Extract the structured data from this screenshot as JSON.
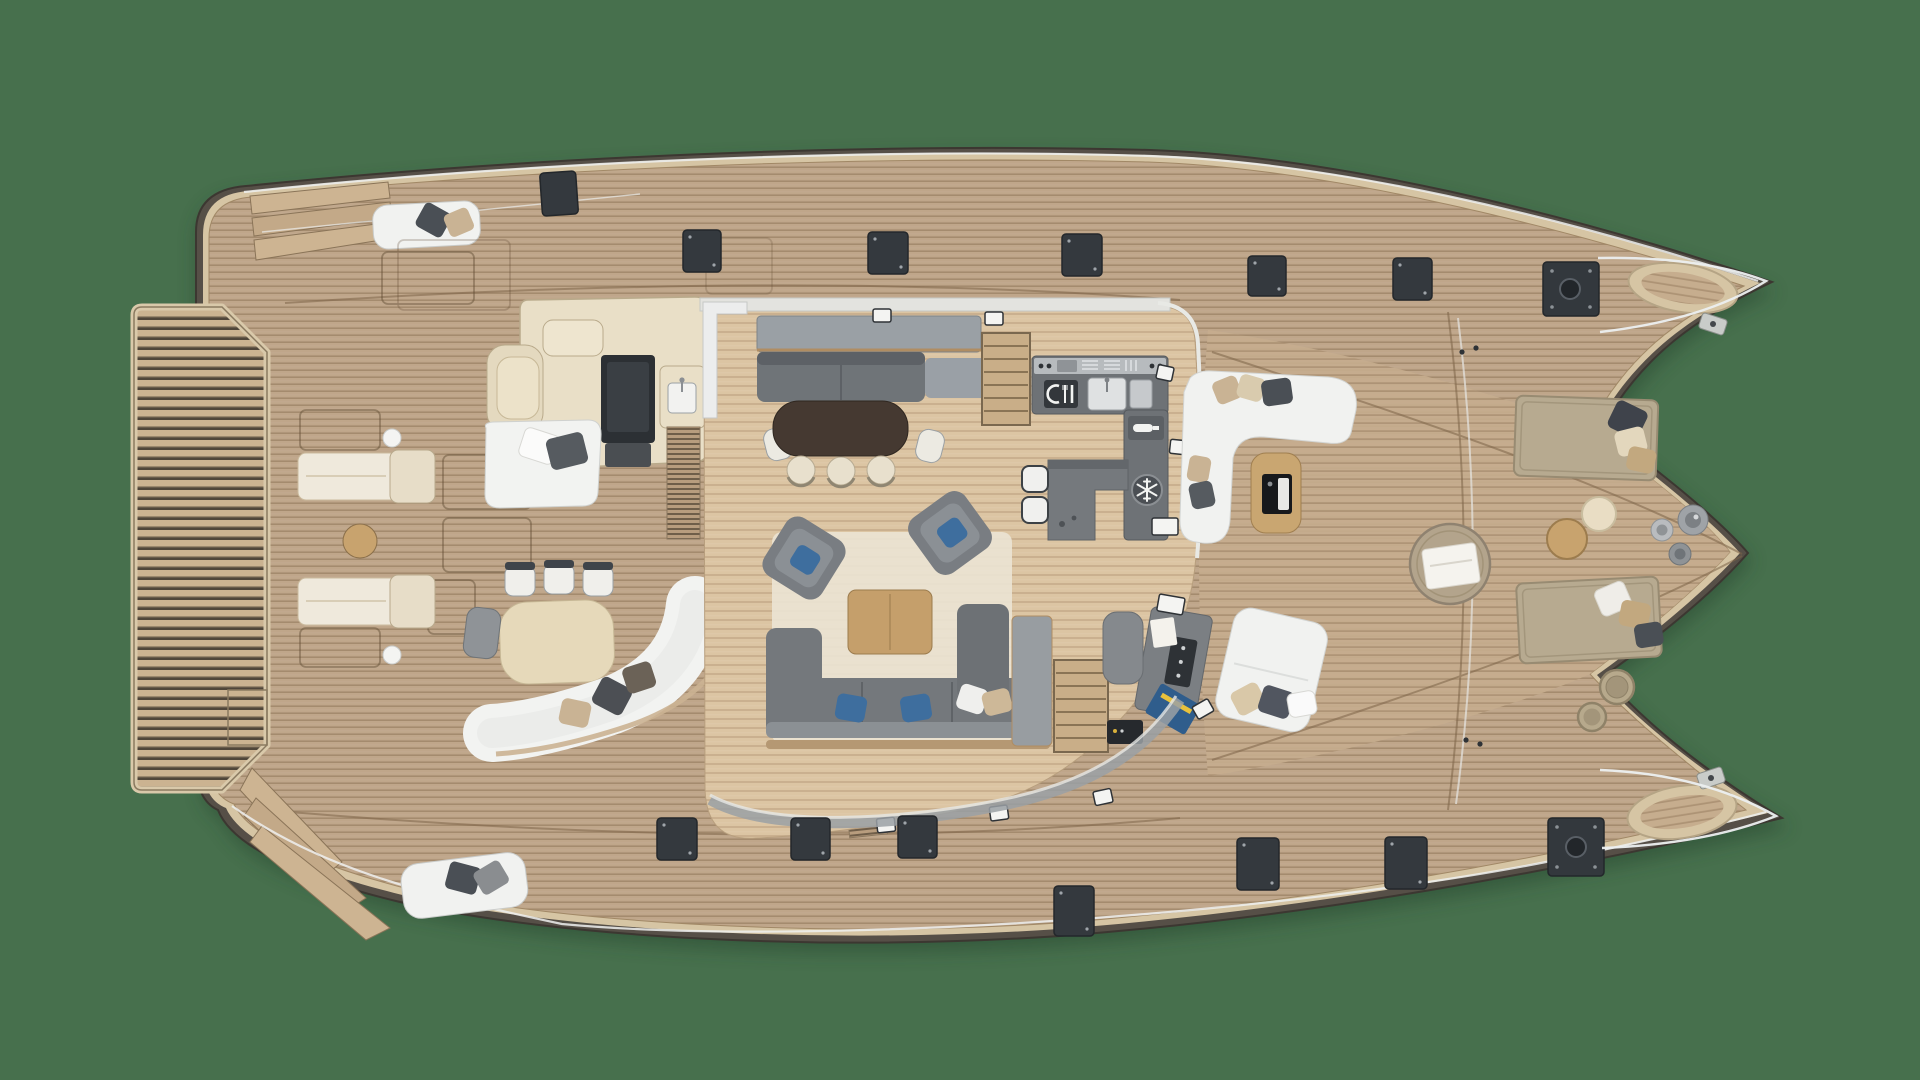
{
  "title": "Catamaran yacht deck plan - top view",
  "colors": {
    "background": "#47704d",
    "hull_side": "#564f47",
    "bulwark": "#d6c5a4",
    "deck_teak": "#bfa68a",
    "salon_floor": "#dcc5a3",
    "platform_slat": "#cbb391",
    "platform_gap": "#50463a",
    "white_furniture": "#f1f2f0",
    "cream_furniture": "#e9dfc7",
    "grey_furniture": "#74787c",
    "grey_light": "#9aa0a5",
    "counter_grey": "#6e7276",
    "stainless": "#b7bbbe",
    "hatch_dark": "#34393e",
    "wood_mid": "#c59f6b",
    "dining_table_dark": "#453931",
    "blue_accent": "#3e6e9e",
    "rug": "#eae3d3",
    "sunpad": "#b7aa90",
    "rail_white": "#eef0f0"
  },
  "icons": [
    {
      "name": "cutlery-icon",
      "meaning": "galley cooktop / dishwasher tile",
      "shape": "white plate arc with fork and knife on dark tile"
    },
    {
      "name": "snowflake-icon",
      "meaning": "refrigerator / freezer",
      "shape": "white snowflake in dark circle"
    },
    {
      "name": "bottle-icon",
      "meaning": "wine cooler",
      "shape": "white bottle on dark tile"
    }
  ],
  "areas": [
    {
      "name": "aft-swim-platform",
      "description": "slatted teak platform between hull sterns"
    },
    {
      "name": "aft-deck",
      "description": "sun loungers, round table, outdoor bar with TV and sink, outdoor dining table with chairs, white sofas"
    },
    {
      "name": "main-salon",
      "description": "dark dining table with cream chairs, grey sofas, armchairs, coffee table on rug"
    },
    {
      "name": "galley",
      "description": "L-shaped grey counters with cooktop, sinks, wine cooler, fridge, island with two stools"
    },
    {
      "name": "navigation-station",
      "description": "chart desk with electronics, chart and seat"
    },
    {
      "name": "forward-cockpit",
      "description": "white C-shaped lounge, teak table with console, white daybed, round pouf with towel"
    },
    {
      "name": "foredeck",
      "description": "two sun pads with pillows, round side tables, vases, rope baskets, deck vents"
    },
    {
      "name": "bows",
      "description": "twin bow tips with pulpit rails and anchor fittings"
    }
  ],
  "counts": {
    "deck_hatches_top": 6,
    "deck_hatches_bottom": 6,
    "deck_vents_large": 2,
    "sun_loungers_aft": 2,
    "sun_pads_foredeck": 2
  }
}
